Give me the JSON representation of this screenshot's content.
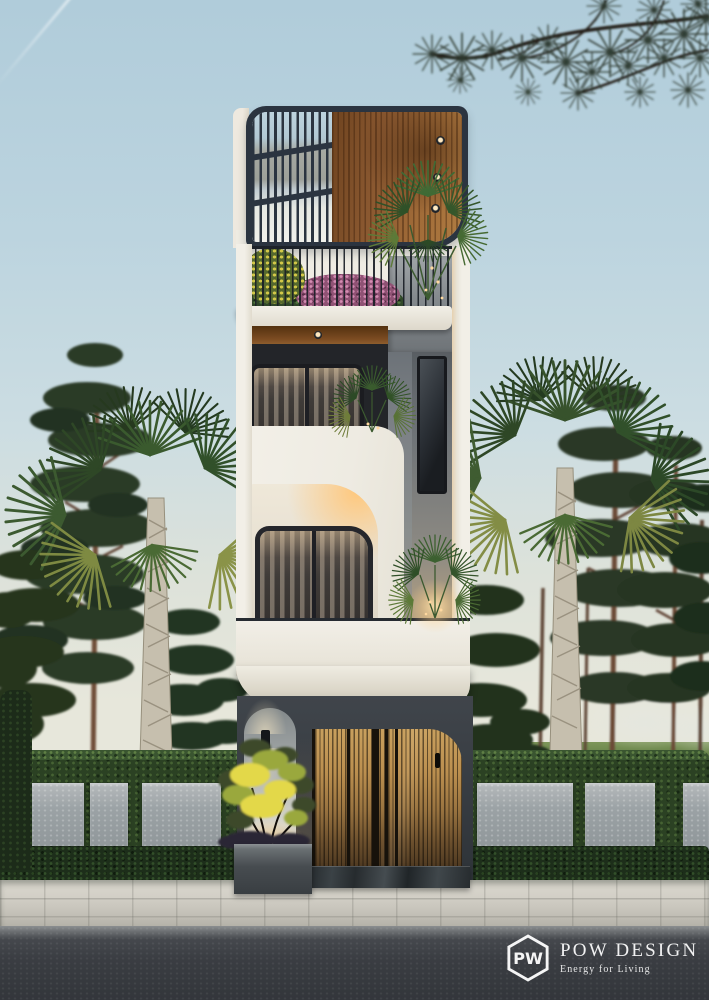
{
  "scene": {
    "setting": "modern narrow townhouse street elevation at dusk",
    "sky": {
      "top": "#b0ccda",
      "horizon": "#e7e7db"
    },
    "palette": {
      "facade_white": "#f1ede5",
      "canopy_frame": "#2b3440",
      "wood_ceiling": "#8a5830",
      "gate_wood": "#bb8f4f",
      "concrete_gray": "#8a8e8d",
      "dark_wall": "#3c4146",
      "hedge_green": "#2b4123",
      "pine_green": "#2c3a26",
      "accent_glow": "#ffd9a0",
      "sidewalk": "#cfccc3",
      "road": "#3a3e42"
    }
  },
  "watermark": {
    "brand": "POW DESIGN",
    "tagline": "Energy for Living",
    "logo_monogram": "PW"
  }
}
